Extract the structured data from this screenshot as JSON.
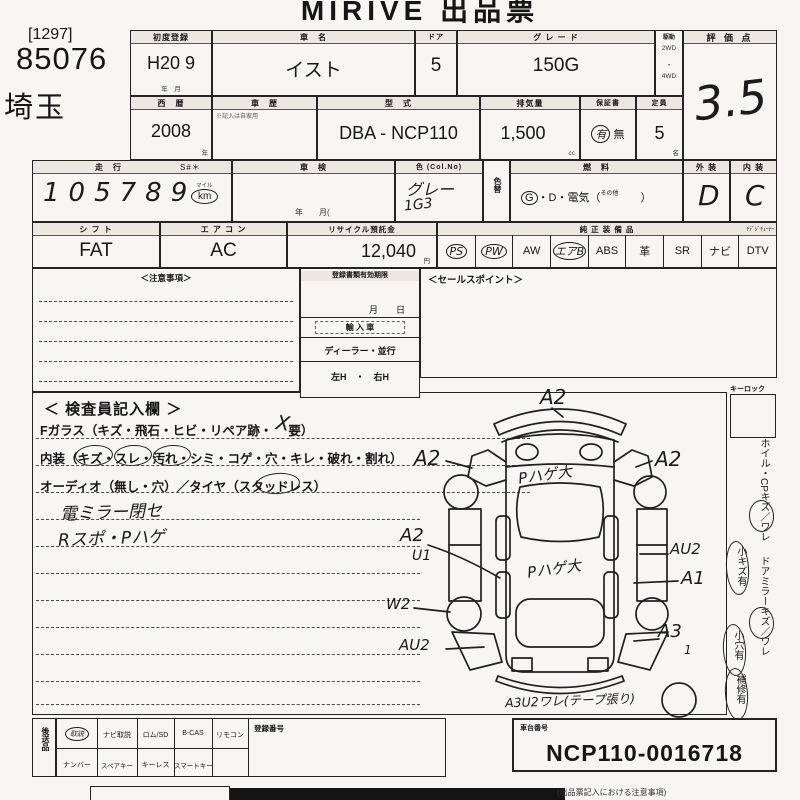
{
  "title": "MIRIVE 出品票",
  "header": {
    "bracket_no": "[1297]",
    "lot_no": "85076",
    "prefecture": "埼玉"
  },
  "row1": {
    "first_reg_label": "初度登録",
    "first_reg": "H20 9",
    "first_reg_unit": "年　月",
    "name_label": "車　名",
    "name": "イスト",
    "door_label": "ドア",
    "door": "5",
    "grade_label": "グ レ ー ド",
    "grade": "150G",
    "drive_label": "駆動",
    "drive_top": "2WD",
    "drive_dot": "・",
    "drive_bottom": "4WD",
    "score_label": "評 価 点",
    "score": "3.5"
  },
  "row2": {
    "year_label": "西　暦",
    "year": "2008",
    "year_unit": "年",
    "history_label": "車　歴",
    "history_note": "※記入は自家用",
    "model_label": "型　式",
    "model": "DBA - NCP110",
    "disp_label": "排気量",
    "disp": "1,500",
    "disp_unit": "cc",
    "record_label": "保証書",
    "record_yes": "有",
    "record_no": "無",
    "capacity_label": "定員",
    "capacity": "5",
    "capacity_unit": "名"
  },
  "row3": {
    "mileage_label": "走　行",
    "s_label": "S#＊",
    "mileage": "105789",
    "mile_top": "マイル",
    "mile_unit": "km",
    "shaken_label": "車　検",
    "shaken_unit": "年　　月(",
    "color_label": "色 (Col.No)",
    "color": "グレー",
    "color_no": "1G3",
    "color_change_label": "色替",
    "fuel_label": "燃　料",
    "fuel_g": "G",
    "fuel_mid": "・D・電気（",
    "fuel_other": "その他",
    "fuel_close": "　　）",
    "ext_label": "外 装",
    "ext": "D",
    "int_label": "内 装",
    "int": "C"
  },
  "row4": {
    "shift_label": "シ フ ト",
    "shift": "FAT",
    "ac_label": "エ ア コ ン",
    "ac": "AC",
    "recycle_label": "リサイクル預託金",
    "recycle": "12,040",
    "recycle_unit": "円",
    "equip_label": "純 正 装 備 品",
    "tuner_label": "ﾁﾃﾞｼﾞﾁｭｰﾅｰ",
    "equipment": [
      {
        "label": "PS",
        "circled": true
      },
      {
        "label": "PW",
        "circled": true
      },
      {
        "label": "AW",
        "circled": false
      },
      {
        "label": "エアB",
        "circled": true
      },
      {
        "label": "ABS",
        "circled": false
      },
      {
        "label": "革",
        "circled": false
      },
      {
        "label": "SR",
        "circled": false
      },
      {
        "label": "ナビ",
        "circled": false
      },
      {
        "label": "DTV",
        "circled": false
      }
    ]
  },
  "row5": {
    "caution_label": "＜注意事項＞",
    "validity_label": "登録書類有効期限",
    "validity_unit": "月　　日",
    "import_label": "輸 入 車",
    "dealer_label": "ディーラー・並行",
    "steering_label": "左H　・　右H",
    "sales_label": "＜セールスポイント＞"
  },
  "inspector": {
    "title": "＜ 検査員記入欄 ＞",
    "glass_line": "Fガラス（キズ・飛石・ヒビ・リペア跡・　 要）",
    "glass_mark": "X",
    "interior_line": "内装（キズ・スレ・汚れ・シミ・コゲ・穴・キレ・破れ・割れ）",
    "audio_line": "オーディオ（無し・穴）／タイヤ（スタッドレス）",
    "note1": "電ミラー閉セ",
    "note2": "Rスポ・Pハゲ"
  },
  "diagram": {
    "front_bumper": "A2",
    "left_mirror": "A2",
    "right_mirror": "A2",
    "hood": "Pハゲ大",
    "roof": "Pハゲ大",
    "left_fender": "A2",
    "left_fender2": "U1",
    "right_door": "AU2",
    "right_rear_door": "A1",
    "left_rear_wheel": "W2",
    "left_quarter": "AU2",
    "right_quarter": "A3",
    "right_quarter_sub": "1",
    "rear_note": "A3U2ワレ(テープ張り)"
  },
  "sidebar": {
    "keylock_label": "キーロック",
    "item1": "ホイル・CPキズ／ワレ",
    "item2": "小キズ有",
    "item3": "ドアミラーキズ／ワレ",
    "item4": "小穴有",
    "item5": "補修有"
  },
  "bottom": {
    "forward_label": "後送品",
    "cells_top": [
      "取説",
      "ナビ取説",
      "ロム/SD",
      "B-CAS",
      "リモコン"
    ],
    "cells_bottom": [
      "ナンバー",
      "スペアキー",
      "キーレス",
      "スマートキー"
    ],
    "reg_label": "登録番号",
    "chassis_label": "車台番号",
    "chassis": "NCP110-0016718",
    "footnote": "(出品票記入における注意事項)"
  }
}
